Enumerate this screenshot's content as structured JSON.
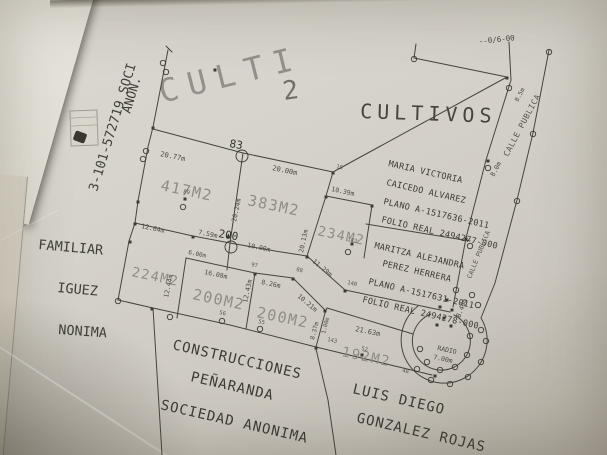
{
  "photo": {
    "corner_note": "--0/6-00"
  },
  "titles": {
    "faint_large": "CULTI",
    "zone_number": "2",
    "cultivos": "CULTIVOS"
  },
  "adjoining": {
    "company_id": "3-101-572719 SOCI",
    "anon": "ANON.",
    "familiar": "FAMILIAR",
    "iguez": "IGUEZ",
    "nonima": "NONIMA",
    "construcciones": [
      "CONSTRUCCIONES",
      "PEÑARANDA",
      "SOCIEDAD ANONIMA"
    ],
    "luis": [
      "LUIS DIEGO",
      "GONZALEZ ROJAS"
    ]
  },
  "owners": {
    "maria": [
      "MARIA VICTORIA",
      "CAICEDO ALVAREZ",
      "PLANO A-1517636-2011",
      "FOLIO REAL 2494277-000"
    ],
    "maritza": [
      "MARITZA ALEJANDRA",
      "PEREZ HERRERA",
      "PLANO A-1517631-2011",
      "FOLIO REAL 2494278-000"
    ]
  },
  "parcels": {
    "p417": "417M2",
    "p383": "383M2",
    "p234": "234M2",
    "p224": "224M2",
    "p200a": "200M2",
    "p200b": "200M2",
    "p192": "192M2"
  },
  "roads": {
    "calle_upper": "CALLE PUBLICA",
    "calle_lower": "CALLE PUBLICA",
    "radio_label": "RADIO",
    "radio_value": "7.00m"
  },
  "measurements": {
    "m_2077": "20.77m",
    "m_2000": "20.00m",
    "m_2024": "20.24m",
    "m_1039": "10.39m",
    "m_2013": "20.13m",
    "m_1264": "12.64m",
    "m_759": "7.59m",
    "m_1000": "10.00m",
    "m_600": "6.00m",
    "m_1608": "16.08m",
    "m_826": "8.26m",
    "m_1244": "12.44m",
    "m_1243": "12.43m",
    "m_1129": "11.29m",
    "m_1021": "10.21m",
    "m_2163": "21.63m",
    "m_837": "8.37m",
    "m_100": "1.00m",
    "m_840": "8.40m",
    "m_80": "8.0m",
    "m_85": "8.5m"
  },
  "points": {
    "p83": "83",
    "p200": "200",
    "small": [
      "15",
      "97",
      "88",
      "56",
      "55",
      "143",
      "52",
      "48",
      "89",
      "182",
      "140"
    ]
  },
  "colors": {
    "ink": "#45453e",
    "faint_ink": "#8d8d85",
    "paper": "#d5d2ca"
  }
}
